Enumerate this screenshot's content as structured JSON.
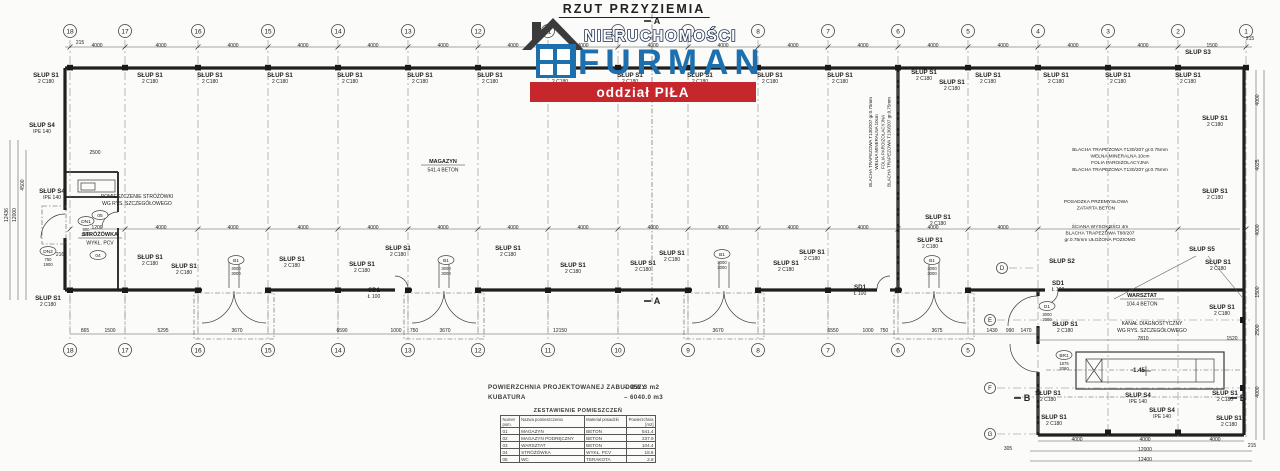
{
  "title": "RZUT PRZYZIEMIA",
  "logo": {
    "line1": "NIERUCHOMOŚCI",
    "line2": "FURMAN",
    "banner": "oddział PIŁA",
    "colors": {
      "blue": "#1d6fad",
      "navy": "#1e3050",
      "red": "#c5272d",
      "roof": "#3b3b3b"
    }
  },
  "summary": {
    "area_label": "POWIERZCHNIA PROJEKTOWANEJ ZABUDOWY",
    "area_value": "–  952.3  m2",
    "volume_label": "KUBATURA",
    "volume_value": "–  6040.0  m3"
  },
  "rooms_table": {
    "title": "ZESTAWIENIE POMIESZCZEŃ",
    "headers": [
      "Numer pom.",
      "Nazwa pomieszczenia",
      "Materiał posadzki",
      "Powierzchnia [m2]"
    ],
    "rows": [
      [
        "01",
        "MAGAZYN",
        "BETON",
        "541.4"
      ],
      [
        "02",
        "MAGAZYN PODRĘCZNY",
        "BETON",
        "237.9"
      ],
      [
        "03",
        "WARSZTAT",
        "BETON",
        "104.4"
      ],
      [
        "04",
        "STRÓŻÓWKA",
        "WYKŁ. PCV",
        "18.9"
      ],
      [
        "05",
        "WC",
        "TERAKOTA",
        "2.8"
      ]
    ]
  },
  "plan": {
    "grid_top": [
      {
        "n": "18",
        "x": 70
      },
      {
        "n": "17",
        "x": 125
      },
      {
        "n": "16",
        "x": 198
      },
      {
        "n": "15",
        "x": 268
      },
      {
        "n": "14",
        "x": 338
      },
      {
        "n": "13",
        "x": 408
      },
      {
        "n": "12",
        "x": 478
      },
      {
        "n": "11",
        "x": 548
      },
      {
        "n": "10",
        "x": 618
      },
      {
        "n": "9",
        "x": 688
      },
      {
        "n": "8",
        "x": 758
      },
      {
        "n": "7",
        "x": 828
      },
      {
        "n": "6",
        "x": 898
      },
      {
        "n": "5",
        "x": 968
      },
      {
        "n": "4",
        "x": 1038
      },
      {
        "n": "3",
        "x": 1108
      },
      {
        "n": "2",
        "x": 1178
      },
      {
        "n": "1",
        "x": 1246
      }
    ],
    "grid_bottom": [
      {
        "n": "18",
        "x": 70
      },
      {
        "n": "17",
        "x": 125
      },
      {
        "n": "16",
        "x": 198
      },
      {
        "n": "15",
        "x": 268
      },
      {
        "n": "14",
        "x": 338
      },
      {
        "n": "13",
        "x": 408
      },
      {
        "n": "12",
        "x": 478
      },
      {
        "n": "11",
        "x": 548
      },
      {
        "n": "10",
        "x": 618
      },
      {
        "n": "9",
        "x": 688
      },
      {
        "n": "8",
        "x": 758
      },
      {
        "n": "7",
        "x": 828
      },
      {
        "n": "6",
        "x": 898
      },
      {
        "n": "5",
        "x": 968
      }
    ],
    "grid_rows": [
      {
        "n": "D",
        "x": 1002,
        "y": 268
      },
      {
        "n": "E",
        "x": 990,
        "y": 320
      },
      {
        "n": "F",
        "x": 990,
        "y": 388
      },
      {
        "n": "G",
        "x": 990,
        "y": 434
      }
    ],
    "slups": [
      [
        46,
        77,
        "SŁUP S1",
        "2 C180"
      ],
      [
        150,
        77,
        "SŁUP S1",
        "2 C180"
      ],
      [
        210,
        77,
        "SŁUP S1",
        "2 C180"
      ],
      [
        280,
        77,
        "SŁUP S1",
        "2 C180"
      ],
      [
        350,
        77,
        "SŁUP S1",
        "2 C180"
      ],
      [
        420,
        77,
        "SŁUP S1",
        "2 C180"
      ],
      [
        490,
        77,
        "SŁUP S1",
        "2 C180"
      ],
      [
        560,
        77,
        "SŁUP S1",
        "2 C180"
      ],
      [
        630,
        77,
        "SŁUP S1",
        "2 C180"
      ],
      [
        700,
        77,
        "SŁUP S1",
        "2 C180"
      ],
      [
        770,
        77,
        "SŁUP S1",
        "2 C180"
      ],
      [
        840,
        77,
        "SŁUP S1",
        "2 C180"
      ],
      [
        924,
        74,
        "SŁUP S1",
        "2 C180"
      ],
      [
        952,
        84,
        "SŁUP S1",
        "2 C180"
      ],
      [
        988,
        77,
        "SŁUP S1",
        "2 C180"
      ],
      [
        1056,
        77,
        "SŁUP S1",
        "2 C180"
      ],
      [
        1118,
        77,
        "SŁUP S1",
        "2 C180"
      ],
      [
        1188,
        77,
        "SŁUP S1",
        "2 C180"
      ],
      [
        1198,
        54,
        "SŁUP S3",
        ""
      ],
      [
        150,
        259,
        "SŁUP S1",
        "2 C180"
      ],
      [
        184,
        268,
        "SŁUP S1",
        "2 C180"
      ],
      [
        292,
        261,
        "SŁUP S1",
        "2 C180"
      ],
      [
        362,
        266,
        "SŁUP S1",
        "2 C180"
      ],
      [
        398,
        250,
        "SŁUP S1",
        "2 C180"
      ],
      [
        508,
        250,
        "SŁUP S1",
        "2 C180"
      ],
      [
        573,
        267,
        "SŁUP S1",
        "2 C180"
      ],
      [
        643,
        265,
        "SŁUP S1",
        "2 C180"
      ],
      [
        672,
        255,
        "SŁUP S1",
        "2 C180"
      ],
      [
        786,
        265,
        "SŁUP S1",
        "2 C180"
      ],
      [
        812,
        254,
        "SŁUP S1",
        "2 C180"
      ],
      [
        938,
        219,
        "SŁUP S1",
        "2 C180"
      ],
      [
        930,
        242,
        "SŁUP S1",
        "2 C180"
      ],
      [
        1215,
        120,
        "SŁUP S1",
        "2 C180"
      ],
      [
        1215,
        193,
        "SŁUP S1",
        "2 C180"
      ],
      [
        1218,
        264,
        "SŁUP S1",
        "2 C180"
      ],
      [
        1222,
        309,
        "SŁUP S1",
        "2 C180"
      ],
      [
        1202,
        251,
        "SŁUP S5",
        ""
      ],
      [
        1062,
        263,
        "SŁUP S2",
        ""
      ],
      [
        1065,
        326,
        "SŁUP S1",
        "2 C180"
      ],
      [
        1048,
        395,
        "SŁUP S1",
        "2 C180"
      ],
      [
        1054,
        419,
        "SŁUP S1",
        "2 C180"
      ],
      [
        1225,
        395,
        "SŁUP S1",
        "2 C180"
      ],
      [
        1229,
        420,
        "SŁUP S1",
        "2 C180"
      ],
      [
        42,
        127,
        "SŁUP S4",
        "IPE 140"
      ],
      [
        52,
        193,
        "SŁUP S4",
        "IPE 140"
      ],
      [
        1138,
        397,
        "SŁUP S4",
        "IPE 140"
      ],
      [
        1162,
        412,
        "SŁUP S4",
        "IPE 140"
      ],
      [
        48,
        300,
        "SŁUP S1",
        "2 C180"
      ]
    ],
    "sd_tags": [
      [
        374,
        292
      ],
      [
        860,
        289
      ],
      [
        1058,
        285
      ]
    ],
    "sd_label": {
      "t": "SD1",
      "s": "Ł 100"
    },
    "ovals": [
      [
        86,
        221,
        "DN1",
        "900/2000"
      ],
      [
        48,
        251,
        "DN2",
        "750/1900"
      ],
      [
        236,
        260,
        "B1",
        "3000/3000"
      ],
      [
        446,
        260,
        "B1",
        "3000/3000"
      ],
      [
        722,
        254,
        "B1",
        "3000/3000"
      ],
      [
        932,
        260,
        "B1",
        "3000/3000"
      ],
      [
        1047,
        306,
        "D1",
        "3000/2000"
      ],
      [
        1064,
        355,
        "BR1",
        "1875/2060"
      ],
      [
        100,
        215,
        "05",
        ""
      ],
      [
        98,
        255,
        "04",
        ""
      ]
    ],
    "room_tags": [
      [
        443,
        163,
        "MAGAZYN",
        "541.4  BETON"
      ],
      [
        1142,
        297,
        "WARSZTAT",
        "104.4  BETON"
      ],
      [
        100,
        236,
        "STRÓŻÓWKA",
        "WYKŁ. PCV"
      ]
    ],
    "notes": [
      {
        "x": 137,
        "y": 198,
        "s": 5,
        "lines": [
          "POMIESZCZENIE STRÓŻÓWKI",
          "WG RYS. SZCZEGÓŁOWEGO"
        ]
      },
      {
        "x": 872,
        "y": 142,
        "s": 4.5,
        "rot": 1,
        "lines": [
          "BLACHA TRAPEZOWA T130/207 gr.0.75mm",
          "WEŁNA MINERALNA 10cm",
          "FOLIA PAROIZOLACYJNA",
          "BLACHA TRAPEZOWA T130/207 gr.0.75mm"
        ]
      },
      {
        "x": 1120,
        "y": 151,
        "s": 4.8,
        "lines": [
          "BLACHA TRAPEZOWA T130/207 gr.0.75mm",
          "WEŁNA MINERALNA 10cm",
          "FOLIA PAROIZOLACYJNA",
          "BLACHA TRAPEZOWA T130/207 gr.0.75mm"
        ]
      },
      {
        "x": 1096,
        "y": 203,
        "s": 4.8,
        "lines": [
          "POSADZKA PRZEMYSŁOWA",
          "ZATARTA BETON"
        ]
      },
      {
        "x": 1100,
        "y": 228,
        "s": 4.8,
        "lines": [
          "ŚCIANA WYSOKOŚCI 4m",
          "BLACHA TRAPEZOWA T80/207",
          "gr.0.75mm UŁOŻONA POZIOMO"
        ]
      },
      {
        "x": 1152,
        "y": 325,
        "s": 5,
        "lines": [
          "KANAŁ DIAGNOSTYCZNY",
          "WG RYS. SZCZEGÓŁOWEGO"
        ]
      }
    ],
    "level_mark": {
      "x": 1138,
      "y": 372,
      "t": "-1.45"
    },
    "sections": [
      [
        654,
        24,
        "A"
      ],
      [
        654,
        304,
        "A"
      ],
      [
        1024,
        401,
        "B"
      ],
      [
        1240,
        401,
        "B"
      ]
    ],
    "dims": [
      [
        97,
        47,
        "4000"
      ],
      [
        161,
        47,
        "4000"
      ],
      [
        233,
        47,
        "4000"
      ],
      [
        303,
        47,
        "4000"
      ],
      [
        373,
        47,
        "4000"
      ],
      [
        443,
        47,
        "4000"
      ],
      [
        513,
        47,
        "4000"
      ],
      [
        583,
        47,
        "4000"
      ],
      [
        653,
        47,
        "4000"
      ],
      [
        723,
        47,
        "4000"
      ],
      [
        793,
        47,
        "4000"
      ],
      [
        863,
        47,
        "4000"
      ],
      [
        933,
        47,
        "4000"
      ],
      [
        1003,
        47,
        "4000"
      ],
      [
        1073,
        47,
        "4000"
      ],
      [
        1143,
        47,
        "4000"
      ],
      [
        1212,
        47,
        "1500"
      ],
      [
        1250,
        40,
        "215"
      ],
      [
        80,
        44,
        "215"
      ],
      [
        97,
        229,
        "1200"
      ],
      [
        161,
        229,
        "4000"
      ],
      [
        233,
        229,
        "4000"
      ],
      [
        303,
        229,
        "4000"
      ],
      [
        373,
        229,
        "4000"
      ],
      [
        443,
        229,
        "4000"
      ],
      [
        513,
        229,
        "4000"
      ],
      [
        583,
        229,
        "4000"
      ],
      [
        653,
        229,
        "4000"
      ],
      [
        723,
        229,
        "4000"
      ],
      [
        793,
        229,
        "4000"
      ],
      [
        863,
        229,
        "4000"
      ],
      [
        933,
        229,
        "4000"
      ],
      [
        1003,
        229,
        "4000"
      ],
      [
        85,
        332,
        "865"
      ],
      [
        110,
        332,
        "1500"
      ],
      [
        163,
        332,
        "5295"
      ],
      [
        237,
        332,
        "3670"
      ],
      [
        342,
        332,
        "6590"
      ],
      [
        396,
        332,
        "1000"
      ],
      [
        414,
        332,
        "750"
      ],
      [
        445,
        332,
        "3670"
      ],
      [
        560,
        332,
        "12150"
      ],
      [
        718,
        332,
        "3670"
      ],
      [
        833,
        332,
        "6550"
      ],
      [
        868,
        332,
        "1000"
      ],
      [
        884,
        332,
        "750"
      ],
      [
        937,
        332,
        "3675"
      ],
      [
        992,
        332,
        "1430"
      ],
      [
        1010,
        332,
        "990"
      ],
      [
        1026,
        332,
        "1470"
      ],
      [
        1077,
        441,
        "4000"
      ],
      [
        1145,
        441,
        "4000"
      ],
      [
        1215,
        441,
        "4000"
      ],
      [
        1145,
        451,
        "12000"
      ],
      [
        1145,
        461,
        "12400"
      ],
      [
        1008,
        450,
        "305"
      ],
      [
        1252,
        447,
        "215"
      ],
      [
        1143,
        340,
        "7810"
      ],
      [
        1232,
        340,
        "1520"
      ],
      [
        8,
        215,
        "12436",
        1
      ],
      [
        16,
        215,
        "12000",
        1
      ],
      [
        24,
        185,
        "4500",
        1
      ],
      [
        1259,
        100,
        "4000",
        1
      ],
      [
        1259,
        165,
        "4025",
        1
      ],
      [
        1259,
        230,
        "4000",
        1
      ],
      [
        1259,
        292,
        "1500",
        1
      ],
      [
        1259,
        330,
        "2500",
        1
      ],
      [
        1259,
        392,
        "4000",
        1
      ],
      [
        95,
        154,
        "2500"
      ],
      [
        60,
        256,
        "216"
      ]
    ]
  }
}
